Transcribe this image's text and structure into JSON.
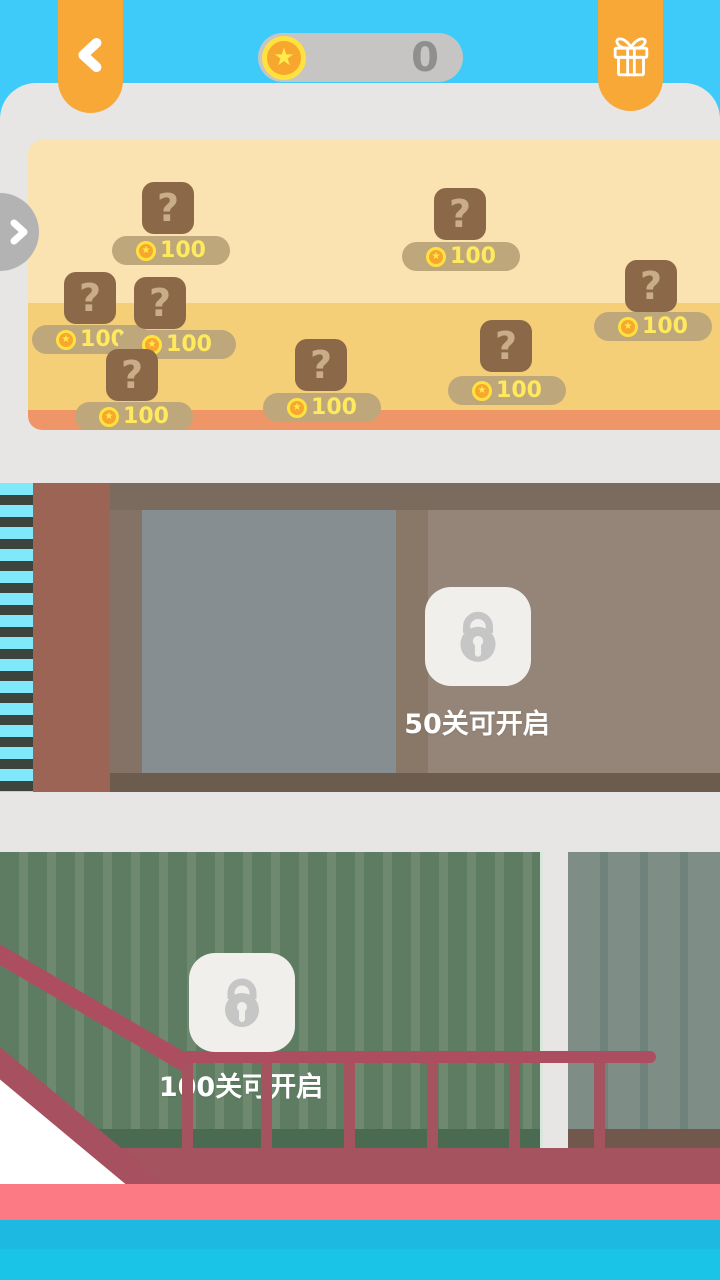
{
  "header": {
    "coin_count": "0"
  },
  "crates": [
    {
      "symbol": "?",
      "price": "100"
    },
    {
      "symbol": "?",
      "price": "100"
    },
    {
      "symbol": "?",
      "price": "100"
    },
    {
      "symbol": "?",
      "price": "100"
    },
    {
      "symbol": "?",
      "price": "100"
    },
    {
      "symbol": "?",
      "price": "100"
    },
    {
      "symbol": "?",
      "price": "100"
    },
    {
      "symbol": "?",
      "price": "100"
    }
  ],
  "scenes": [
    {
      "unlock_text": "50关可开启"
    },
    {
      "unlock_text": "100关可开启"
    }
  ],
  "icons": {
    "back": "chevron-left",
    "gift": "gift-box",
    "coin": "star-coin",
    "expand": "chevron-right",
    "lock": "padlock"
  },
  "colors": {
    "sky": "#3ECBF9",
    "sheet_gray": "#E7E6E5",
    "accent_orange": "#F8A837",
    "coin_gold": "#F8A72E",
    "coin_ring": "#FFE23F",
    "sand_light": "#FBE3B1",
    "sand_mid": "#F4CF78",
    "sand_salmon": "#EF9668",
    "crate_brown": "#8A6848",
    "price_yellow": "#FFE95C",
    "railing_red": "#AD4E60",
    "floor_pink": "#FB7A84",
    "water_blue": "#1DB9E1"
  }
}
